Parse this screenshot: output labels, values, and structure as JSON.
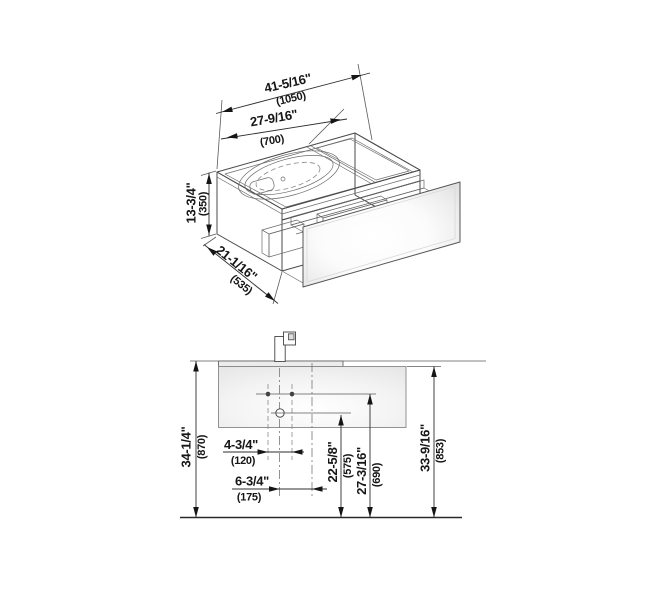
{
  "drawing": {
    "iso": {
      "width_in": "41-5/16\"",
      "width_mm": "(1050)",
      "basin_in": "27-9/16\"",
      "basin_mm": "(700)",
      "height_in": "13-3/4\"",
      "height_mm": "(350)",
      "depth_in": "21-1/16\"",
      "depth_mm": "(535)"
    },
    "front": {
      "total_height_in": "34-1/4\"",
      "total_height_mm": "(870)",
      "cabinet_height_in": "33-9/16\"",
      "cabinet_height_mm": "(853)",
      "hole_spacing_in": "4-3/4\"",
      "hole_spacing_mm": "(120)",
      "center_offset_in": "6-3/4\"",
      "center_offset_mm": "(175)",
      "drain_height_in": "22-5/8\"",
      "drain_height_mm": "(575)",
      "supply_height_in": "27-3/16\"",
      "supply_height_mm": "(690)"
    }
  }
}
